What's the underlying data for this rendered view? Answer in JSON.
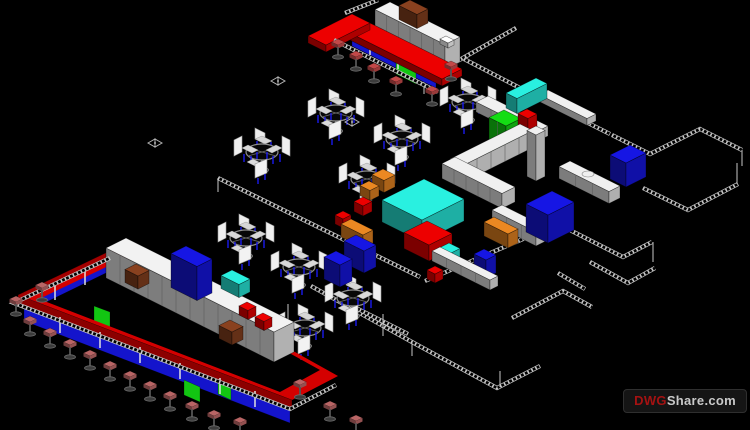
{
  "canvas": {
    "width": 750,
    "height": 430,
    "background": "#000000"
  },
  "watermark": {
    "prefix": "DWG",
    "suffix": "Share.com",
    "prefix_color": "#a51212",
    "suffix_color": "#c9c9c9",
    "background": "#151515",
    "border": "#2f2f2f"
  },
  "palette": {
    "background": "#000000",
    "wall_line": "#c9c9c9",
    "counter_red": "#d40000",
    "panel_blue": "#1414cc",
    "panel_green": "#12c512",
    "equipment_cyan": "#25d6c8",
    "cabinet_orange": "#d2791e",
    "coffee_machine_brown": "#7a3a1c",
    "furniture_white": "#d8d8d8",
    "chair_leg_blue": "#1a1aee",
    "stool_seat_pink": "#b96565",
    "stool_seat_red": "#c24848",
    "stool_base_gray": "#3c3c3c"
  },
  "scene": {
    "walls": [
      {
        "n": "wall-top-left-notch",
        "pts": [
          [
            345,
            13
          ],
          [
            378,
            0
          ]
        ]
      },
      {
        "n": "wall-top-right-a",
        "pts": [
          [
            516,
            28
          ],
          [
            424,
            80
          ]
        ]
      },
      {
        "n": "wall-top-right-b",
        "pts": [
          [
            464,
            59
          ],
          [
            574,
            116
          ]
        ]
      },
      {
        "n": "wall-mid-diagonal",
        "pts": [
          [
            218,
            178
          ],
          [
            420,
            277
          ]
        ]
      },
      {
        "n": "wall-bottom-rooms-outer",
        "pts": [
          [
            311,
            286
          ],
          [
            412,
            342
          ],
          [
            497,
            388
          ],
          [
            540,
            366
          ]
        ]
      },
      {
        "n": "wall-bottom-rooms-inner",
        "pts": [
          [
            340,
            300
          ],
          [
            408,
            334
          ]
        ]
      },
      {
        "n": "wall-mid-right-long",
        "pts": [
          [
            425,
            281
          ],
          [
            558,
            224
          ]
        ]
      },
      {
        "n": "wall-kitchen-right",
        "pts": [
          [
            558,
            224
          ],
          [
            623,
            257
          ],
          [
            652,
            242
          ]
        ]
      },
      {
        "n": "wall-right-mid",
        "pts": [
          [
            574,
            116
          ],
          [
            610,
            134
          ]
        ]
      },
      {
        "n": "wall-far-right-top",
        "pts": [
          [
            612,
            135
          ],
          [
            650,
            154
          ],
          [
            700,
            129
          ],
          [
            742,
            150
          ]
        ]
      },
      {
        "n": "wall-far-right-mid",
        "pts": [
          [
            643,
            188
          ],
          [
            688,
            210
          ],
          [
            738,
            184
          ]
        ]
      },
      {
        "n": "wall-right-small-room",
        "pts": [
          [
            590,
            262
          ],
          [
            628,
            283
          ],
          [
            655,
            268
          ]
        ]
      },
      {
        "n": "wall-right-short",
        "pts": [
          [
            558,
            273
          ],
          [
            585,
            289
          ]
        ]
      },
      {
        "n": "wall-bottom-right-l",
        "pts": [
          [
            512,
            318
          ],
          [
            563,
            291
          ],
          [
            592,
            307
          ]
        ]
      }
    ],
    "rails": [
      {
        "n": "bottom-bar-foot-rail",
        "pts": [
          [
            110,
            258
          ],
          [
            14,
            303
          ],
          [
            290,
            409
          ],
          [
            336,
            385
          ]
        ]
      },
      {
        "n": "top-bar-foot-rail",
        "pts": [
          [
            334,
            40
          ],
          [
            438,
            92
          ]
        ]
      }
    ],
    "ticks": [
      [
        424,
        80,
        424,
        94
      ],
      [
        218,
        178,
        218,
        192
      ],
      [
        383,
        314,
        383,
        336
      ],
      [
        288,
        304,
        288,
        320
      ],
      [
        653,
        242,
        653,
        262
      ],
      [
        737,
        163,
        737,
        184
      ],
      [
        500,
        371,
        500,
        387
      ],
      [
        742,
        150,
        742,
        166
      ],
      [
        412,
        342,
        412,
        356
      ]
    ],
    "polys": [
      {
        "n": "bottom-bar-blue-front-upper",
        "pts": [
          [
            108,
            256
          ],
          [
            30,
            294
          ],
          [
            30,
            310
          ],
          [
            108,
            272
          ]
        ],
        "c": "#1414cc"
      },
      {
        "n": "bottom-bar-blue-front-lower",
        "pts": [
          [
            24,
            303
          ],
          [
            290,
            405
          ],
          [
            290,
            423
          ],
          [
            24,
            321
          ]
        ],
        "c": "#1414cc"
      },
      {
        "n": "bottom-bar-green-panel-1",
        "pts": [
          [
            94,
            306
          ],
          [
            110,
            312
          ],
          [
            110,
            328
          ],
          [
            94,
            322
          ]
        ],
        "c": "#12c512"
      },
      {
        "n": "bottom-bar-green-panel-2",
        "pts": [
          [
            184,
            380
          ],
          [
            200,
            387
          ],
          [
            200,
            402
          ],
          [
            184,
            395
          ]
        ],
        "c": "#12c512"
      },
      {
        "n": "bottom-bar-green-panel-3",
        "pts": [
          [
            218,
            381
          ],
          [
            231,
            387
          ],
          [
            231,
            400
          ],
          [
            218,
            394
          ]
        ],
        "c": "#12c512"
      },
      {
        "n": "bottom-bar-red-counter-ring",
        "d": "M112,250 L18,295 L292,400 L338,376 Z M121,260 L39,299 L280,392 L320,370 Z",
        "c": "#d40000",
        "fr": "evenodd"
      },
      {
        "n": "bottom-bar-red-ring-front-face",
        "pts": [
          [
            18,
            295
          ],
          [
            292,
            400
          ],
          [
            292,
            408
          ],
          [
            18,
            303
          ]
        ],
        "c": "#8c0000"
      },
      {
        "n": "bottom-bar-red-ring-left-face",
        "pts": [
          [
            112,
            250
          ],
          [
            18,
            295
          ],
          [
            18,
            303
          ],
          [
            112,
            258
          ]
        ],
        "c": "#a30000"
      },
      {
        "n": "top-bar-blue-front",
        "pts": [
          [
            352,
            28
          ],
          [
            436,
            70
          ],
          [
            436,
            88
          ],
          [
            352,
            46
          ]
        ],
        "c": "#1414cc"
      },
      {
        "n": "top-bar-green-panel",
        "pts": [
          [
            396,
            62
          ],
          [
            416,
            72
          ],
          [
            416,
            84
          ],
          [
            396,
            74
          ]
        ],
        "c": "#12c512"
      }
    ],
    "lines": [
      [
        55,
        284,
        55,
        300
      ],
      [
        85,
        269,
        85,
        285
      ],
      [
        60,
        317,
        60,
        333
      ],
      [
        100,
        332,
        100,
        348
      ],
      [
        140,
        347,
        140,
        363
      ],
      [
        180,
        363,
        180,
        379
      ],
      [
        220,
        378,
        220,
        394
      ],
      [
        255,
        391,
        255,
        407
      ],
      [
        370,
        37,
        370,
        55
      ],
      [
        398,
        51,
        398,
        69
      ]
    ],
    "boxes": [
      {
        "n": "upper-white-counter",
        "t": [
          488,
          96
        ],
        "a": 60,
        "b": 12,
        "h": 10,
        "c": "#d6d6d6",
        "s": 4
      },
      {
        "n": "upper-white-table",
        "t": [
          548,
          90
        ],
        "a": 48,
        "b": 9,
        "h": 7,
        "c": "#d6d6d6"
      },
      {
        "n": "cyan-display-case",
        "t": [
          536,
          78
        ],
        "a": 11,
        "b": 30,
        "h": 15,
        "c": "#25d6c8"
      },
      {
        "n": "green-fridge",
        "t": [
          504,
          110
        ],
        "a": 17,
        "b": 15,
        "h": 28,
        "c": "#12c512",
        "s": 2
      },
      {
        "n": "green-small-unit",
        "t": [
          495,
          138
        ],
        "a": 11,
        "b": 9,
        "h": 12,
        "c": "#12c512"
      },
      {
        "n": "red-equipment-box",
        "t": [
          527,
          109
        ],
        "a": 10,
        "b": 9,
        "h": 13,
        "c": "#d40000"
      },
      {
        "n": "kitchen-counter-left-wing",
        "t": [
          520,
          124
        ],
        "a": 13,
        "b": 70,
        "h": 17,
        "c": "#d6d6d6",
        "s": 5
      },
      {
        "n": "kitchen-counter-bottom-wing",
        "t": [
          455,
          157
        ],
        "a": 60,
        "b": 13,
        "h": 15,
        "c": "#d6d6d6",
        "s": 5
      },
      {
        "n": "kitchen-column",
        "t": [
          536,
          126
        ],
        "a": 9,
        "b": 9,
        "h": 46,
        "c": "#d6d6d6"
      },
      {
        "n": "sink-counter",
        "t": [
          570,
          161
        ],
        "a": 50,
        "b": 11,
        "h": 12,
        "c": "#d6d6d6",
        "s": 3
      },
      {
        "n": "orange-cabinet-a",
        "t": [
          383,
          169
        ],
        "a": 12,
        "b": 11,
        "h": 12,
        "c": "#d2791e"
      },
      {
        "n": "orange-cabinet-b",
        "t": [
          369,
          181
        ],
        "a": 10,
        "b": 9,
        "h": 10,
        "c": "#d2791e"
      },
      {
        "n": "red-small-box-a",
        "t": [
          363,
          197
        ],
        "a": 9,
        "b": 9,
        "h": 10,
        "c": "#d40000"
      },
      {
        "n": "red-small-box-b",
        "t": [
          343,
          211
        ],
        "a": 8,
        "b": 8,
        "h": 9,
        "c": "#d40000"
      },
      {
        "n": "exhaust-hood-cyan",
        "t": [
          424,
          179
        ],
        "a": 40,
        "b": 42,
        "h": 22,
        "c": "#25d6c8"
      },
      {
        "n": "red-cooking-range",
        "t": [
          427,
          221
        ],
        "a": 25,
        "b": 23,
        "h": 16,
        "c": "#d40000"
      },
      {
        "n": "cyan-small-unit",
        "t": [
          449,
          243
        ],
        "a": 11,
        "b": 10,
        "h": 11,
        "c": "#25d6c8"
      },
      {
        "n": "orange-long-cabinet-a",
        "t": [
          351,
          219
        ],
        "a": 22,
        "b": 10,
        "h": 13,
        "c": "#d2791e"
      },
      {
        "n": "blue-counter-a",
        "t": [
          356,
          235
        ],
        "a": 20,
        "b": 12,
        "h": 22,
        "c": "#1414cc"
      },
      {
        "n": "blue-counter-b",
        "t": [
          336,
          251
        ],
        "a": 16,
        "b": 12,
        "h": 22,
        "c": "#1414cc"
      },
      {
        "n": "white-counter-mid",
        "t": [
          502,
          205
        ],
        "a": 44,
        "b": 10,
        "h": 14,
        "c": "#d6d6d6",
        "s": 3
      },
      {
        "n": "orange-long-cabinet-b",
        "t": [
          494,
          217
        ],
        "a": 24,
        "b": 10,
        "h": 14,
        "c": "#d2791e"
      },
      {
        "n": "blue-sofa-a",
        "t": [
          552,
          191
        ],
        "a": 22,
        "b": 26,
        "h": 28,
        "c": "#1414cc"
      },
      {
        "n": "blue-sofa-b",
        "t": [
          630,
          145
        ],
        "a": 16,
        "b": 20,
        "h": 24,
        "c": "#1414cc"
      },
      {
        "n": "blue-wall-panel",
        "t": [
          484,
          249
        ],
        "a": 12,
        "b": 10,
        "h": 18,
        "c": "#1414cc"
      },
      {
        "n": "white-counter-low",
        "t": [
          440,
          247
        ],
        "a": 58,
        "b": 8,
        "h": 10,
        "c": "#d6d6d6",
        "s": 4
      },
      {
        "n": "red-small-box-c",
        "t": [
          435,
          266
        ],
        "a": 8,
        "b": 8,
        "h": 9,
        "c": "#d40000"
      },
      {
        "n": "top-bar-back-shelf",
        "t": [
          390,
          2
        ],
        "a": 70,
        "b": 15,
        "h": 25,
        "c": "#d8d8d8",
        "s": 6
      },
      {
        "n": "top-bar-coffee-machine",
        "t": [
          410,
          0
        ],
        "a": 18,
        "b": 11,
        "h": 14,
        "c": "#7a3a1c"
      },
      {
        "n": "top-bar-red-counter",
        "t": [
          352,
          14
        ],
        "a": 110,
        "b": 20,
        "h": 7,
        "c": "#d40000"
      },
      {
        "n": "top-bar-red-counter-arm",
        "t": [
          352,
          14
        ],
        "a": 18,
        "b": 44,
        "h": 7,
        "c": "#d40000"
      },
      {
        "n": "top-bar-white-item",
        "t": [
          446,
          36
        ],
        "a": 8,
        "b": 6,
        "h": 5,
        "c": "#ececec"
      },
      {
        "n": "bottom-bar-back-shelving",
        "t": [
          126,
          238
        ],
        "a": 168,
        "b": 20,
        "h": 30,
        "c": "#d8d8d8",
        "s": 12
      },
      {
        "n": "bottom-bar-blue-unit",
        "t": [
          186,
          246
        ],
        "a": 26,
        "b": 15,
        "h": 34,
        "c": "#1414cc"
      },
      {
        "n": "bottom-bar-coffee-machine-a",
        "t": [
          136,
          264
        ],
        "a": 13,
        "b": 11,
        "h": 13,
        "c": "#7a3a1c"
      },
      {
        "n": "bottom-bar-cyan-case",
        "t": [
          232,
          270
        ],
        "a": 18,
        "b": 11,
        "h": 13,
        "c": "#25d6c8"
      },
      {
        "n": "bottom-bar-coffee-machine-b",
        "t": [
          230,
          320
        ],
        "a": 13,
        "b": 11,
        "h": 13,
        "c": "#7a3a1c"
      },
      {
        "n": "bottom-bar-red-item-a",
        "t": [
          247,
          302
        ],
        "a": 9,
        "b": 8,
        "h": 9,
        "c": "#d40000"
      },
      {
        "n": "bottom-bar-red-item-b",
        "t": [
          263,
          313
        ],
        "a": 9,
        "b": 8,
        "h": 9,
        "c": "#d40000"
      }
    ],
    "tables": [
      [
        336,
        113
      ],
      [
        262,
        152
      ],
      [
        367,
        179
      ],
      [
        402,
        139
      ],
      [
        468,
        102
      ],
      [
        246,
        238
      ],
      [
        299,
        267
      ],
      [
        353,
        298
      ],
      [
        305,
        328
      ]
    ],
    "stools": {
      "top_bar": [
        [
          338,
          42
        ],
        [
          356,
          54
        ],
        [
          374,
          66
        ],
        [
          396,
          79
        ],
        [
          451,
          64
        ],
        [
          432,
          89
        ]
      ],
      "bottom_bar": [
        [
          42,
          285
        ],
        [
          16,
          299
        ],
        [
          30,
          319
        ],
        [
          50,
          331
        ],
        [
          70,
          342
        ],
        [
          90,
          353
        ],
        [
          110,
          364
        ],
        [
          130,
          374
        ],
        [
          150,
          384
        ],
        [
          170,
          394
        ],
        [
          192,
          404
        ],
        [
          214,
          413
        ],
        [
          240,
          420
        ],
        [
          300,
          382
        ],
        [
          330,
          404
        ],
        [
          356,
          418
        ]
      ]
    },
    "markers": [
      [
        155,
        143
      ],
      [
        278,
        81
      ],
      [
        352,
        122
      ]
    ],
    "sink": {
      "cx": 588,
      "cy": 174,
      "rx": 6,
      "ry": 3,
      "c": "#f0f0f0"
    }
  }
}
